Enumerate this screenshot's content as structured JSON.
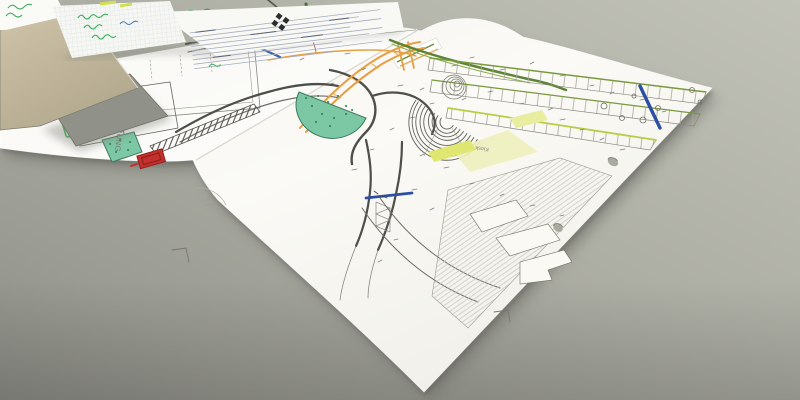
{
  "labels": {
    "plan_title_vertical": "AUSFÜHRUNG",
    "kiosk": "Kiosk"
  },
  "colors": {
    "desk": "#aaaba1",
    "paper": "#f8f7f2",
    "orange_route": "#e79f44",
    "green_route": "#5c8336",
    "lime_highlight": "#cfe24e",
    "yellow_highlight": "#eef0bc",
    "blue_marker": "#2b4fa3",
    "blue_line": "#3a62b0",
    "red_building": "#c4302b",
    "teal_vegetation": "#7cc7a4",
    "green_box": "#3fbf52",
    "handwriting_green": "#3fae62",
    "board_tan": "#c6bb9e"
  }
}
